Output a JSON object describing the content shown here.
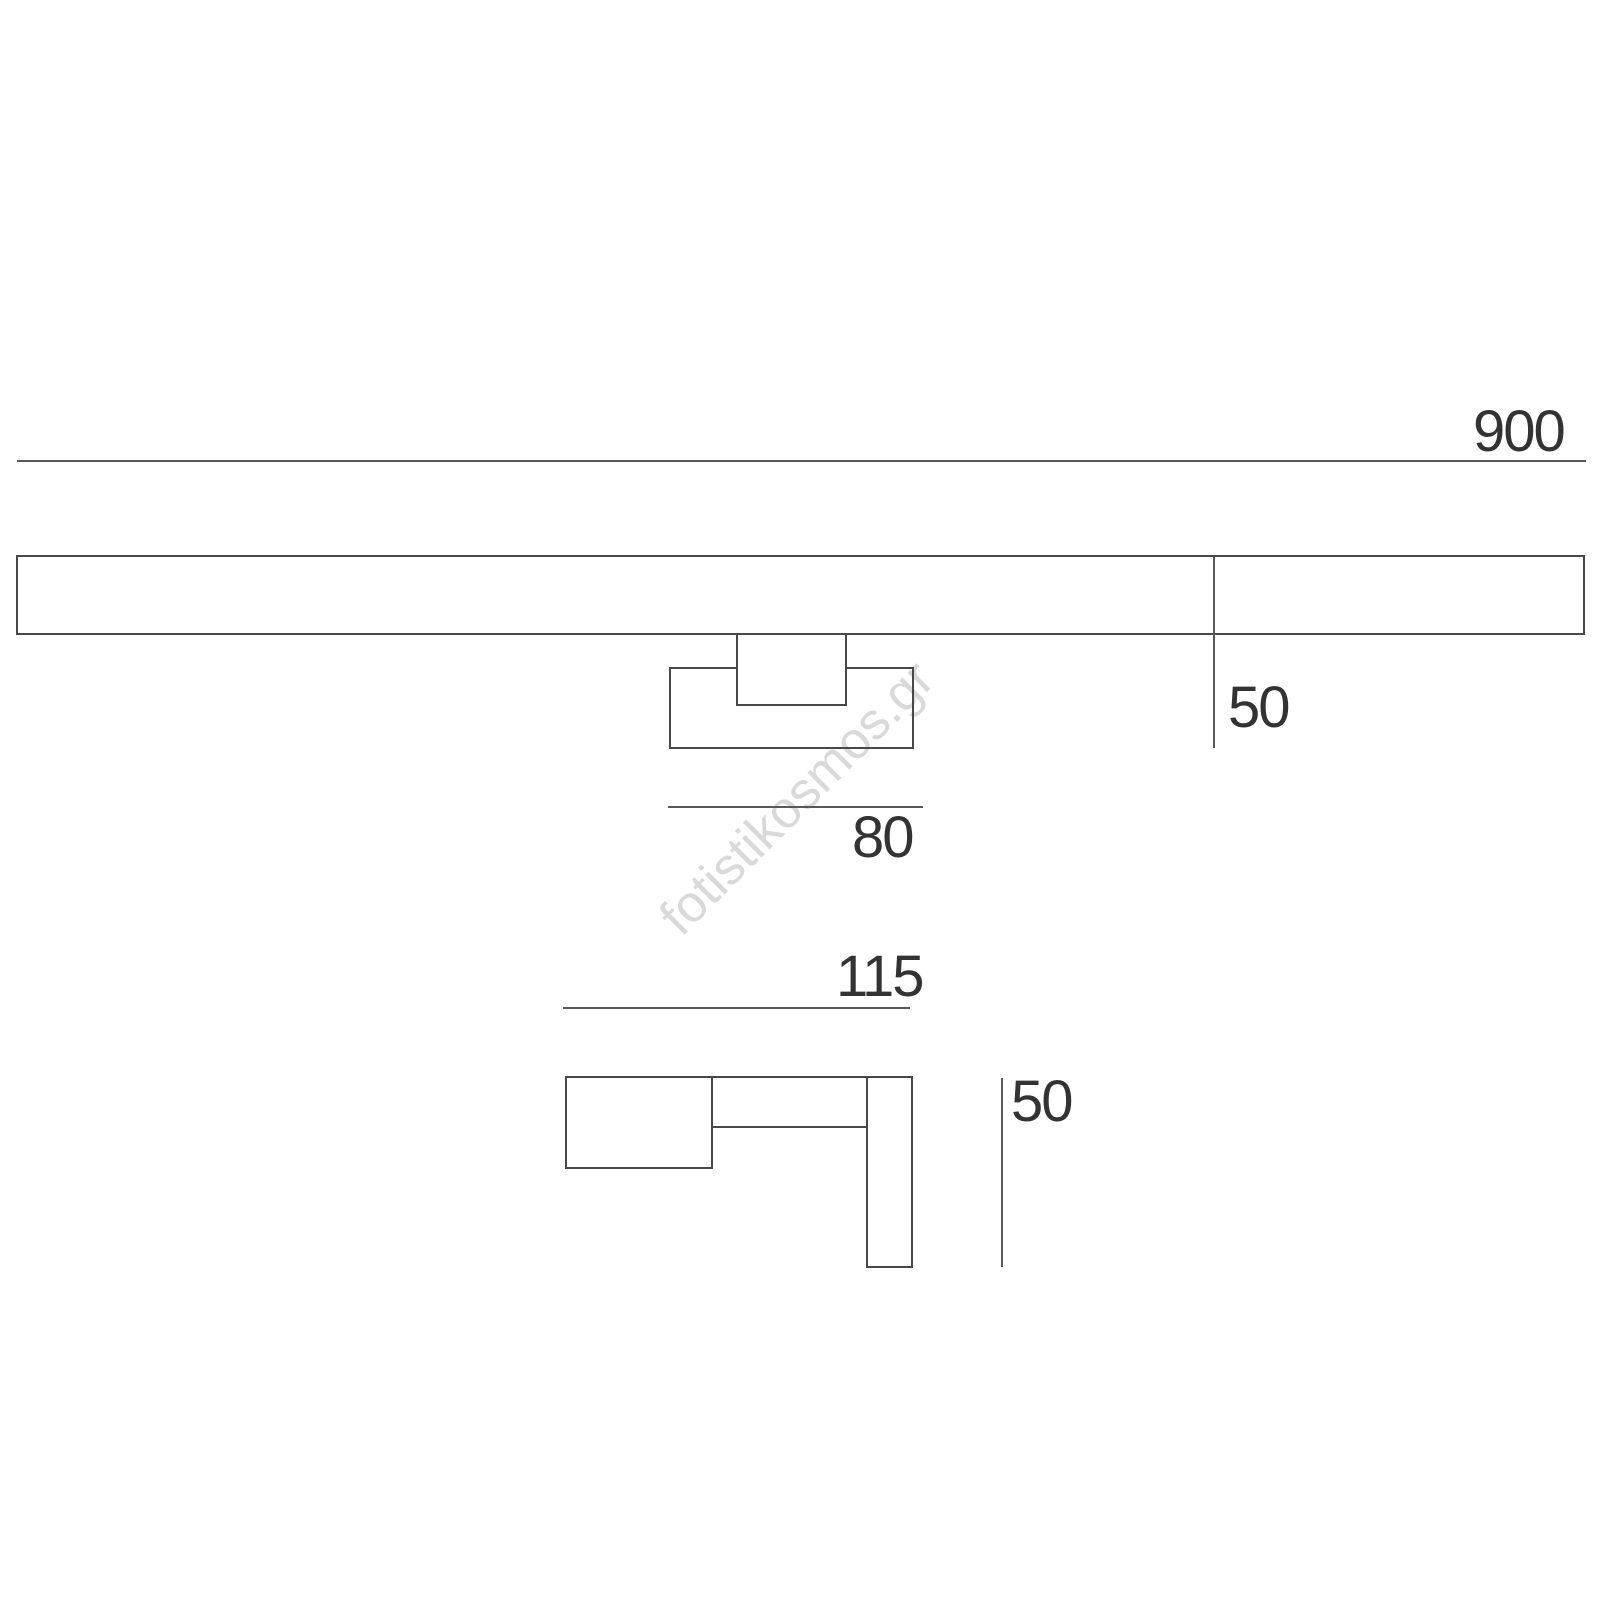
{
  "watermark": {
    "text": "fotistikosmos.gr"
  },
  "dimensions": {
    "front_width": "900",
    "front_height": "50",
    "bracket_width": "80",
    "side_depth": "115",
    "side_height": "50"
  },
  "colors": {
    "background": "#ffffff",
    "shape_line": "#484848",
    "dim_line": "#585858",
    "label_text": "#333333",
    "watermark": "#d9d9d9"
  }
}
